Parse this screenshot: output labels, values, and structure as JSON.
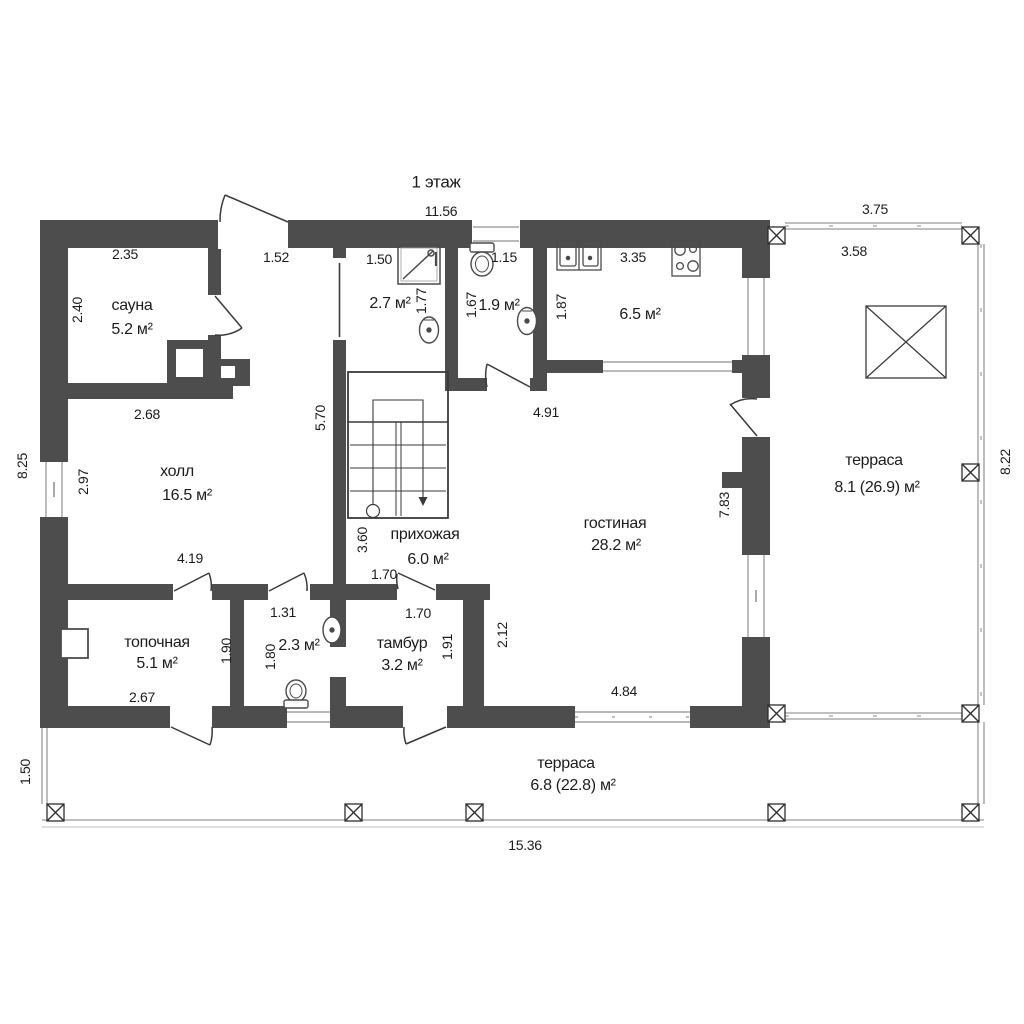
{
  "floor_title": "1 этаж",
  "rooms": {
    "sauna": {
      "name": "сауна",
      "area": "5.2 м²"
    },
    "shower": {
      "area": "2.7 м²"
    },
    "wc": {
      "area": "1.9 м²"
    },
    "kitchen": {
      "area": "6.5 м²"
    },
    "hall": {
      "name": "холл",
      "area": "16.5 м²"
    },
    "hallway": {
      "name": "прихожая",
      "area": "6.0 м²"
    },
    "living": {
      "name": "гостиная",
      "area": "28.2 м²"
    },
    "boiler_room": {
      "name": "топочная",
      "area": "5.1 м²"
    },
    "bathroom": {
      "area": "2.3 м²"
    },
    "tambour": {
      "name": "тамбур",
      "area": "3.2 м²"
    },
    "terrace_right": {
      "name": "терраса",
      "area": "8.1 (26.9) м²"
    },
    "terrace_bottom": {
      "name": "терраса",
      "area": "6.8 (22.8) м²"
    }
  },
  "dims": {
    "building_top": "11.56",
    "building_left": "8.25",
    "terrace_right_width": "3.75",
    "terrace_right_width_inner": "3.58",
    "terrace_right_height": "8.22",
    "terrace_bottom_height": "1.50",
    "terrace_bottom_width": "15.36",
    "sauna_top": "2.35",
    "sauna_left": "2.40",
    "sauna_bottom": "2.68",
    "entry_opening": "1.52",
    "shower_top": "1.50",
    "shower_right": "1.77",
    "wc_left": "1.67",
    "wc_window": "1.15",
    "kitchen_top": "3.35",
    "kitchen_left": "1.87",
    "hall_left": "2.97",
    "hall_right": "5.70",
    "hall_bottom": "4.19",
    "stair_left": "3.60",
    "living_top": "4.91",
    "living_right": "7.83",
    "living_left": "2.12",
    "living_bottom": "4.84",
    "hallway_door": "1.70",
    "tambour_top": "1.70",
    "tambour_right": "1.91",
    "boiler_right": "1.90",
    "boiler_bottom": "2.67",
    "bath_top": "1.31",
    "bath_left": "1.80"
  },
  "colors": {
    "wall": "#4d4d4d",
    "line": "#3a3a3a",
    "railing": "#9a9a9a",
    "text": "#1c1c1c"
  }
}
